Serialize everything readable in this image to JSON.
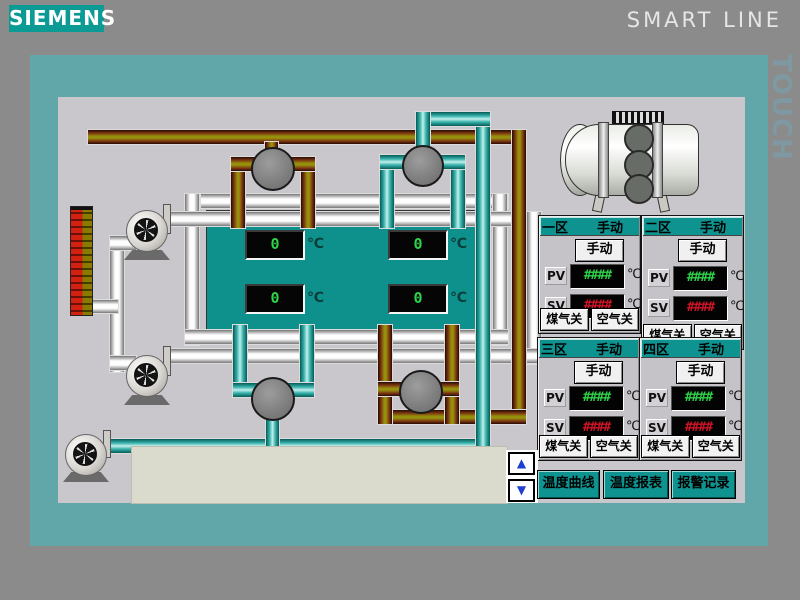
{
  "header": {
    "logo": "SIEMENS",
    "product": "SMART LINE",
    "touch": "TOUCH"
  },
  "furnace": {
    "displays": [
      {
        "value": "0",
        "unit": "℃"
      },
      {
        "value": "0",
        "unit": "℃"
      },
      {
        "value": "0",
        "unit": "℃"
      },
      {
        "value": "0",
        "unit": "℃"
      }
    ]
  },
  "zones": [
    {
      "name": "一区",
      "mode": "手动",
      "manual_button": "手动",
      "pv_label": "PV",
      "pv_value": "####",
      "pv_unit": "℃",
      "sv_label": "SV",
      "sv_value": "####",
      "sv_unit": "℃",
      "gas_button": "煤气关",
      "air_button": "空气关"
    },
    {
      "name": "二区",
      "mode": "手动",
      "manual_button": "手动",
      "pv_label": "PV",
      "pv_value": "####",
      "pv_unit": "℃",
      "sv_label": "SV",
      "sv_value": "####",
      "sv_unit": "℃",
      "gas_button": "煤气关",
      "air_button": "空气关"
    },
    {
      "name": "三区",
      "mode": "手动",
      "manual_button": "手动",
      "pv_label": "PV",
      "pv_value": "####",
      "pv_unit": "℃",
      "sv_label": "SV",
      "sv_value": "####",
      "sv_unit": "℃",
      "gas_button": "煤气关",
      "air_button": "空气关"
    },
    {
      "name": "四区",
      "mode": "手动",
      "manual_button": "手动",
      "pv_label": "PV",
      "pv_value": "####",
      "pv_unit": "℃",
      "sv_label": "SV",
      "sv_value": "####",
      "sv_unit": "℃",
      "gas_button": "煤气关",
      "air_button": "空气关"
    }
  ],
  "nav": {
    "up": "▲",
    "down": "▼",
    "buttons": [
      "温度曲线",
      "温度报表",
      "报警记录"
    ]
  },
  "colors": {
    "accent_teal": "#0f9390",
    "frame_teal": "#61a7a9",
    "logo_teal": "#0b9a94",
    "led_green": "#2ed348",
    "led_red": "#d01325",
    "pipe_gas": "#96900c",
    "pipe_water": "#35b0aa",
    "pipe_air": "#fdfdfd"
  }
}
